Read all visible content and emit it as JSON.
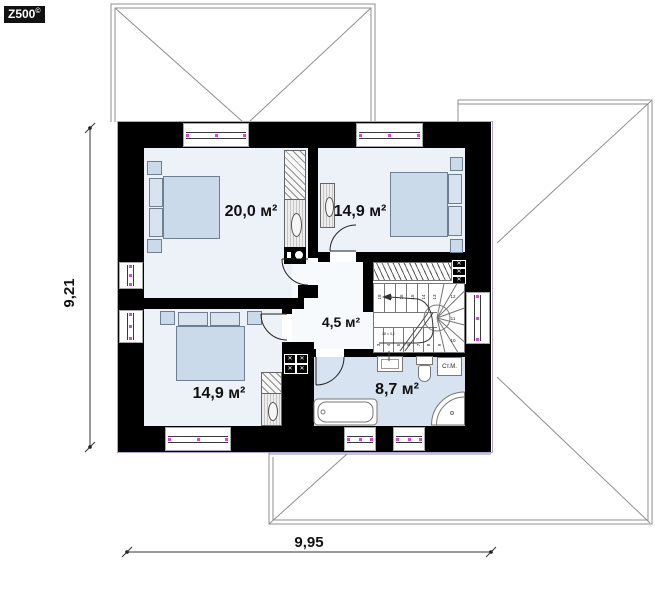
{
  "logo": {
    "brand": "Z500",
    "mark": "©"
  },
  "dimensions": {
    "vertical": "9,21",
    "horizontal": "9,95"
  },
  "plan": {
    "rooms": [
      {
        "id": "bedroom-top-left",
        "area": "20,0 м²"
      },
      {
        "id": "bedroom-top-right",
        "area": "14,9 м²"
      },
      {
        "id": "hall",
        "area": "4,5 м²"
      },
      {
        "id": "bedroom-bottom-left",
        "area": "14,9 м²"
      },
      {
        "id": "bathroom",
        "area": "8,7 м²"
      }
    ],
    "appliances": {
      "washing_machine": "Ст.М."
    },
    "stairs": {
      "note": "18 × 3,2",
      "flight_up": [
        "18",
        "17",
        "16",
        "15",
        "14",
        "13"
      ],
      "winders": [
        "12",
        "11",
        "10"
      ],
      "flight_low": [
        "3",
        "4",
        "5",
        "6",
        "7",
        "8",
        "9"
      ]
    }
  },
  "icons": {
    "vent_cross": "✕"
  },
  "colors": {
    "wall": "#000000",
    "floor_bedroom": "#edf2f8",
    "floor_bath": "#d7e3f1",
    "floor_hall": "#f7fafc",
    "furniture": "#cbdaea",
    "window_marker": "#e83ee8",
    "plan_outline": "#b2a0d8",
    "roof_line": "#8f8f8f"
  }
}
